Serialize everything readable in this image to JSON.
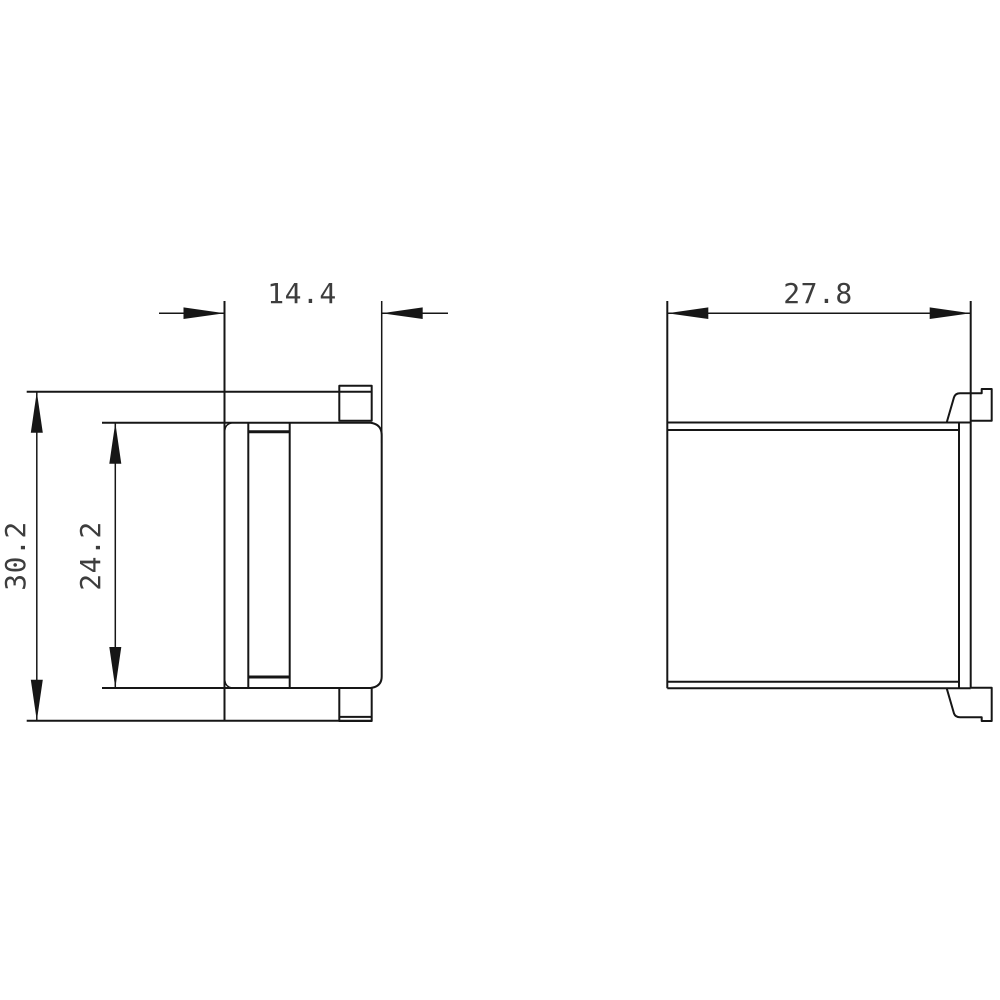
{
  "drawing": {
    "background_color": "#ffffff",
    "line_color": "#161616",
    "dim_text_color": "#3d3d3d",
    "dimensions": {
      "front_width": "14.4",
      "front_overall_height": "30.2",
      "front_inner_height": "24.2",
      "side_width": "27.8"
    }
  }
}
